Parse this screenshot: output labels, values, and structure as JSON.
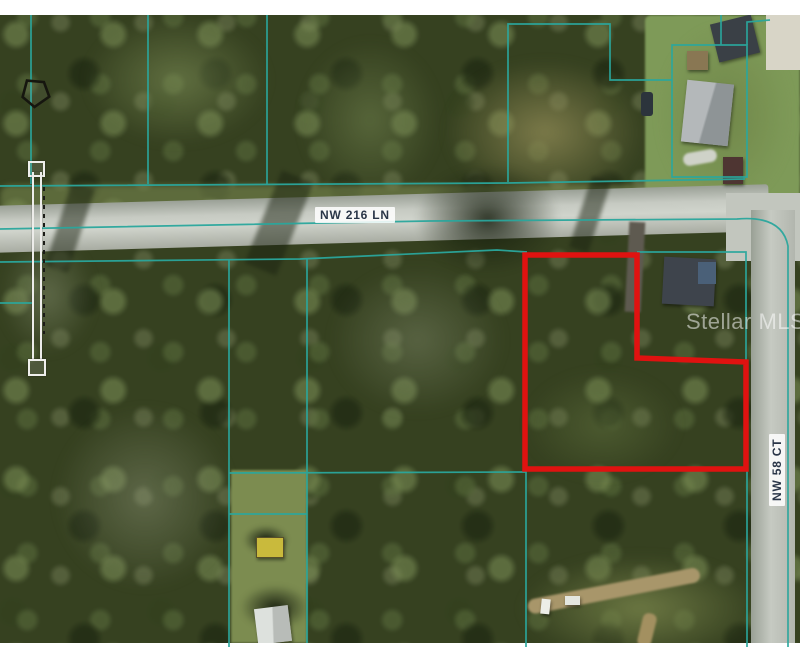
{
  "map": {
    "streets": {
      "horizontal": "NW 216 LN",
      "vertical": "NW 58 CT"
    },
    "watermark": "Stellar MLS",
    "colors": {
      "parcel_line": "#2aa79d",
      "subject_boundary": "#e01210",
      "street_label_text": "#2a3648"
    }
  }
}
